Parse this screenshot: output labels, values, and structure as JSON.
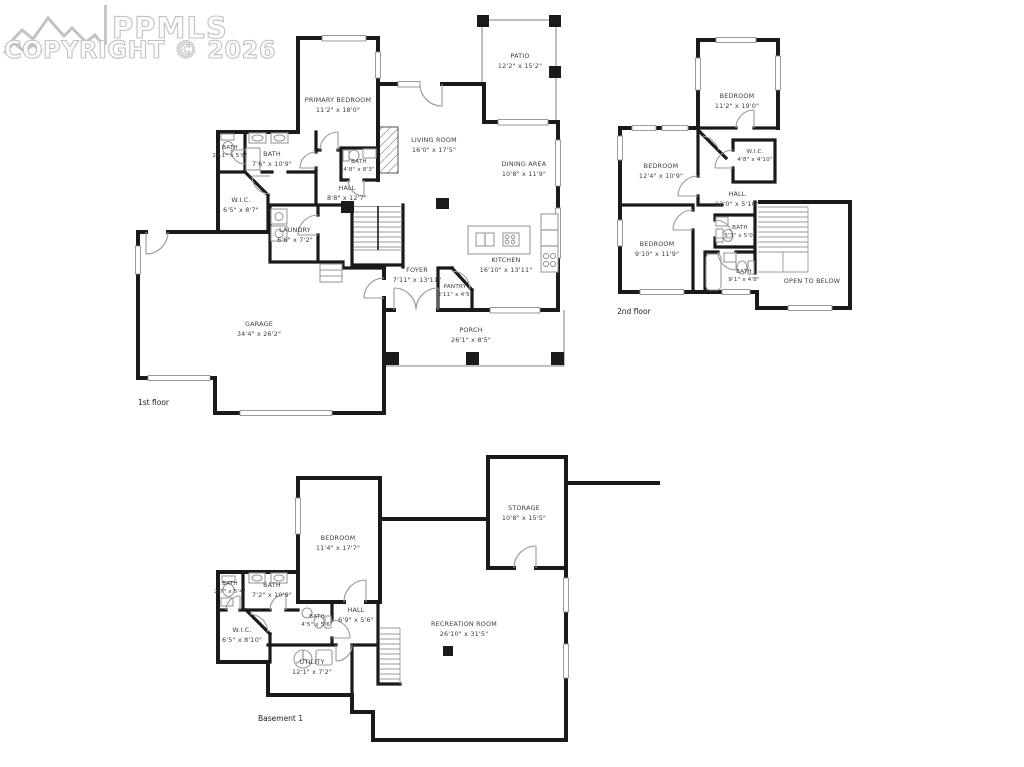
{
  "watermark": {
    "brand": "PPMLS",
    "copyright_line": "COPYRIGHT © 2026"
  },
  "floors": {
    "first": {
      "label": "1st floor",
      "rooms": {
        "primary_bedroom": {
          "name": "PRIMARY BEDROOM",
          "dims": "11'2\" x 18'0\""
        },
        "bath_small": {
          "name": "BATH",
          "dims": "2'11\" x 5'8\""
        },
        "bath_main": {
          "name": "BATH",
          "dims": "7'6\" x 10'9\""
        },
        "bath_powder": {
          "name": "BATH",
          "dims": "4'8\" x 8'3\""
        },
        "wic": {
          "name": "W.I.C.",
          "dims": "6'5\" x 8'7\""
        },
        "hall": {
          "name": "HALL",
          "dims": "8'8\" x 12'7\""
        },
        "laundry": {
          "name": "LAUNDRY",
          "dims": "6'6\" x 7'2\""
        },
        "living_room": {
          "name": "LIVING ROOM",
          "dims": "16'0\" x 17'5\""
        },
        "dining_area": {
          "name": "DINING AREA",
          "dims": "10'8\" x 11'9\""
        },
        "kitchen": {
          "name": "KITCHEN",
          "dims": "16'10\" x 13'11\""
        },
        "foyer": {
          "name": "FOYER",
          "dims": "7'11\" x 13'11\""
        },
        "pantry": {
          "name": "PANTRY",
          "dims": "3'11\" x 4'5\""
        },
        "patio": {
          "name": "PATIO",
          "dims": "12'2\" x 15'2\""
        },
        "porch": {
          "name": "PORCH",
          "dims": "26'1\" x 8'5\""
        },
        "garage": {
          "name": "GARAGE",
          "dims": "34'4\" x 26'2\""
        }
      }
    },
    "second": {
      "label": "2nd floor",
      "rooms": {
        "bedroom_top": {
          "name": "BEDROOM",
          "dims": "11'2\" x 19'0\""
        },
        "bedroom_left": {
          "name": "BEDROOM",
          "dims": "12'4\" x 10'9\""
        },
        "bedroom_bottom": {
          "name": "BEDROOM",
          "dims": "9'10\" x 11'9\""
        },
        "wic": {
          "name": "W.I.C.",
          "dims": "4'8\" x 4'10\""
        },
        "hall": {
          "name": "HALL",
          "dims": "12'0\" x 5'10\""
        },
        "bath_small": {
          "name": "BATH",
          "dims": "5'3\" x 5'0\""
        },
        "bath_main": {
          "name": "BATH",
          "dims": "9'1\" x 4'8\""
        },
        "open_to_below": {
          "name": "OPEN TO BELOW",
          "dims": ""
        }
      }
    },
    "basement": {
      "label": "Basement 1",
      "rooms": {
        "bedroom": {
          "name": "BEDROOM",
          "dims": "11'4\" x 17'7\""
        },
        "storage": {
          "name": "STORAGE",
          "dims": "10'8\" x 15'5\""
        },
        "bath_small": {
          "name": "BATH",
          "dims": "2'7\" x 5'4\""
        },
        "bath_main": {
          "name": "BATH",
          "dims": "7'2\" x 10'9\""
        },
        "bath_three_quarter": {
          "name": "BATH",
          "dims": "4'5\" x 5'6\""
        },
        "wic": {
          "name": "W.I.C.",
          "dims": "6'5\" x 8'10\""
        },
        "hall": {
          "name": "HALL",
          "dims": "6'9\" x 5'6\""
        },
        "utility": {
          "name": "UTILITY",
          "dims": "12'1\" x 7'2\""
        },
        "recreation_room": {
          "name": "RECREATION ROOM",
          "dims": "26'10\" x 31'5\""
        }
      }
    }
  }
}
